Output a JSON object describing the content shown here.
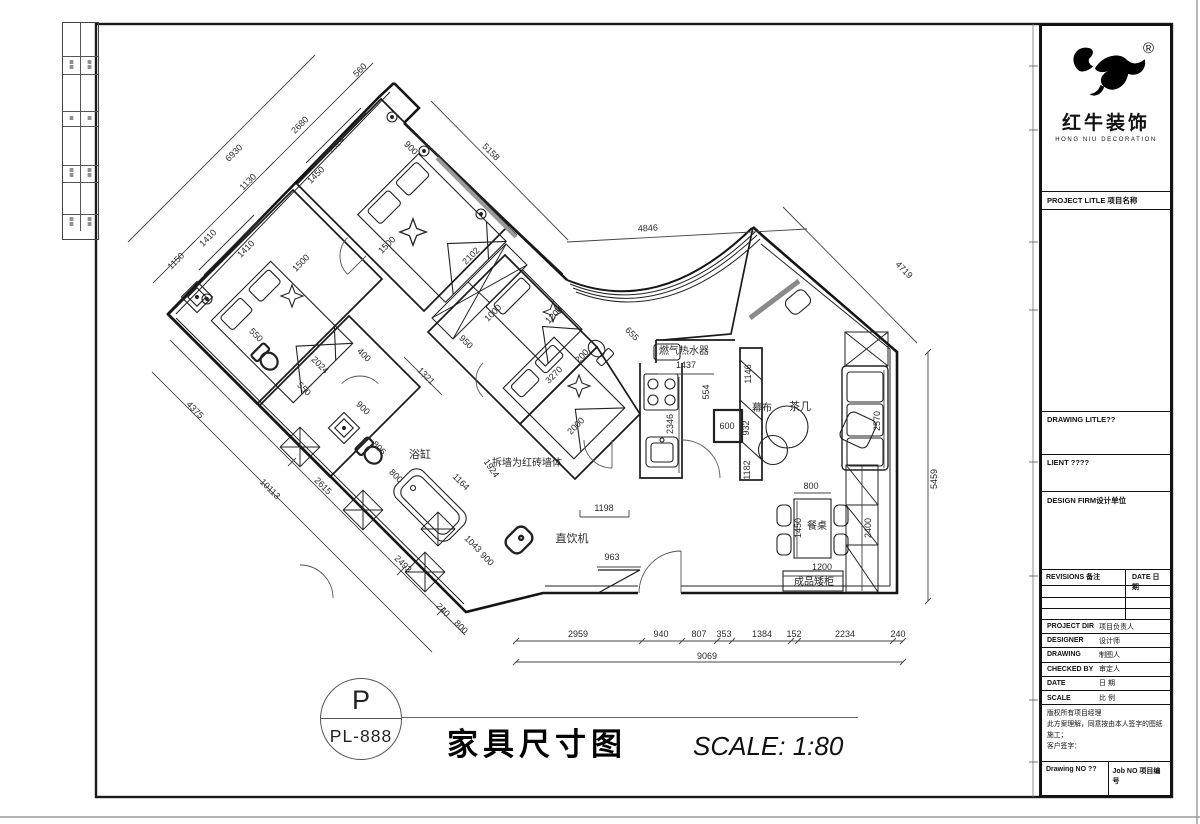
{
  "strip": {
    "glyph": "≣"
  },
  "title_bar": {
    "circle_top": "P",
    "circle_code": "PL-888",
    "title": "家具尺寸图",
    "scale": "SCALE:  1:80"
  },
  "title_block": {
    "logo": {
      "registered": "®",
      "brand": "红牛装饰",
      "brand_en": "HONG NIU DECORATION"
    },
    "project_title": "PROJECT LITLE  项目名称",
    "drawing_title": "DRAWING  LITLE??",
    "client": "LIENT ????",
    "design_firm": "DESIGN  FIRM设计单位",
    "revisions": {
      "col1": "REVISIONS 备注",
      "col2": "DATE 日期"
    },
    "info_rows": [
      {
        "en": "PROJECT DIR",
        "cn": "项目负责人"
      },
      {
        "en": "DESIGNER",
        "cn": "设计师"
      },
      {
        "en": "DRAWING",
        "cn": "制图人"
      },
      {
        "en": "CHECKED BY",
        "cn": "审定人"
      },
      {
        "en": "DATE",
        "cn": "日  期"
      },
      {
        "en": "SCALE",
        "cn": "比  例"
      }
    ],
    "notice": [
      "版权所有项目经理",
      "此方案理解，同意按由本人签字的图纸施工；",
      "客户签字："
    ],
    "footer": {
      "left": "Drawing NO ??",
      "right": "Job NO  项目编号"
    }
  },
  "plan": {
    "labels": [
      {
        "t": "560",
        "x": 362,
        "y": 72,
        "r": -45
      },
      {
        "t": "2680",
        "x": 302,
        "y": 127,
        "r": -45
      },
      {
        "t": "6930",
        "x": 236,
        "y": 155,
        "r": -45
      },
      {
        "t": "1130",
        "x": 250,
        "y": 184,
        "r": -45
      },
      {
        "t": "1410",
        "x": 210,
        "y": 240,
        "r": -45
      },
      {
        "t": "1150",
        "x": 178,
        "y": 263,
        "r": -45
      },
      {
        "t": "1324",
        "x": 338,
        "y": 147,
        "r": -45
      },
      {
        "t": "1450",
        "x": 318,
        "y": 177,
        "r": -45
      },
      {
        "t": "900",
        "x": 409,
        "y": 150,
        "r": 45
      },
      {
        "t": "1500",
        "x": 389,
        "y": 247,
        "r": -45
      },
      {
        "t": "1410",
        "x": 248,
        "y": 251,
        "r": -45
      },
      {
        "t": "1500",
        "x": 303,
        "y": 265,
        "r": -45
      },
      {
        "t": "550",
        "x": 254,
        "y": 337,
        "r": 45
      },
      {
        "t": "5158",
        "x": 489,
        "y": 154,
        "r": 45
      },
      {
        "t": "4846",
        "x": 648,
        "y": 231,
        "r": -3
      },
      {
        "t": "4719",
        "x": 902,
        "y": 272,
        "r": 45
      },
      {
        "t": "655",
        "x": 630,
        "y": 336,
        "r": 45
      },
      {
        "t": "2102",
        "x": 473,
        "y": 258,
        "r": -45
      },
      {
        "t": "1000",
        "x": 495,
        "y": 315,
        "r": -45
      },
      {
        "t": "1200",
        "x": 556,
        "y": 317,
        "r": -45
      },
      {
        "t": "950",
        "x": 464,
        "y": 344,
        "r": 45
      },
      {
        "t": "200",
        "x": 584,
        "y": 358,
        "r": -45
      },
      {
        "t": "3270",
        "x": 556,
        "y": 377,
        "r": -45
      },
      {
        "t": "2000",
        "x": 578,
        "y": 428,
        "r": -45
      },
      {
        "t": "1321",
        "x": 424,
        "y": 378,
        "r": 45
      },
      {
        "t": "2024",
        "x": 318,
        "y": 367,
        "r": 45
      },
      {
        "t": "400",
        "x": 362,
        "y": 357,
        "r": 45
      },
      {
        "t": "550",
        "x": 302,
        "y": 391,
        "r": 45
      },
      {
        "t": "900",
        "x": 361,
        "y": 410,
        "r": 45
      },
      {
        "t": "806",
        "x": 377,
        "y": 450,
        "r": 45
      },
      {
        "t": "800",
        "x": 394,
        "y": 478,
        "r": 45
      },
      {
        "t": "浴缸",
        "x": 420,
        "y": 458,
        "r": 0,
        "s": 11,
        "n": "room-label-bathtub"
      },
      {
        "t": "1164",
        "x": 459,
        "y": 484,
        "r": 45
      },
      {
        "t": "1924",
        "x": 489,
        "y": 470,
        "r": 55
      },
      {
        "t": "拆墙为红砖墙体",
        "x": 527,
        "y": 466,
        "r": 0,
        "s": 10,
        "n": "note-brick-wall"
      },
      {
        "t": "1043",
        "x": 471,
        "y": 546,
        "r": 45
      },
      {
        "t": "900",
        "x": 485,
        "y": 561,
        "r": 45
      },
      {
        "t": "直饮机",
        "x": 572,
        "y": 542,
        "r": 0,
        "s": 11,
        "n": "label-water-dispenser"
      },
      {
        "t": "4375",
        "x": 193,
        "y": 412,
        "r": 45
      },
      {
        "t": "10113",
        "x": 268,
        "y": 491,
        "r": 45
      },
      {
        "t": "2615",
        "x": 321,
        "y": 488,
        "r": 45
      },
      {
        "t": "2493",
        "x": 401,
        "y": 566,
        "r": 45
      },
      {
        "t": "240",
        "x": 441,
        "y": 612,
        "r": 45
      },
      {
        "t": "800",
        "x": 459,
        "y": 629,
        "r": 45
      },
      {
        "t": "963",
        "x": 612,
        "y": 560,
        "r": 0
      },
      {
        "t": "1198",
        "x": 604,
        "y": 511,
        "r": 0
      },
      {
        "t": "燃气热水器",
        "x": 684,
        "y": 354,
        "r": 0,
        "s": 10,
        "n": "label-gas-heater"
      },
      {
        "t": "1437",
        "x": 686,
        "y": 368,
        "r": 0
      },
      {
        "t": "2346",
        "x": 673,
        "y": 424,
        "r": -90
      },
      {
        "t": "554",
        "x": 709,
        "y": 392,
        "r": -90
      },
      {
        "t": "600",
        "x": 727,
        "y": 429,
        "r": 0
      },
      {
        "t": "1146",
        "x": 751,
        "y": 374,
        "r": -90
      },
      {
        "t": "932",
        "x": 749,
        "y": 428,
        "r": -90
      },
      {
        "t": "幕布",
        "x": 762,
        "y": 411,
        "r": 0,
        "s": 10,
        "n": "label-screen"
      },
      {
        "t": "1182",
        "x": 750,
        "y": 470,
        "r": -90
      },
      {
        "t": "茶几",
        "x": 800,
        "y": 410,
        "r": 0,
        "s": 11,
        "n": "label-tea-table"
      },
      {
        "t": "2570",
        "x": 880,
        "y": 421,
        "r": -90
      },
      {
        "t": "800",
        "x": 811,
        "y": 489,
        "r": 0
      },
      {
        "t": "1450",
        "x": 801,
        "y": 528,
        "r": -90
      },
      {
        "t": "餐桌",
        "x": 817,
        "y": 529,
        "r": 0,
        "s": 10,
        "n": "label-dining-table"
      },
      {
        "t": "2400",
        "x": 871,
        "y": 528,
        "r": -90
      },
      {
        "t": "1200",
        "x": 822,
        "y": 570,
        "r": 0
      },
      {
        "t": "成品矮柜",
        "x": 814,
        "y": 585,
        "r": 0,
        "s": 10,
        "n": "label-low-cabinet"
      },
      {
        "t": "5459",
        "x": 937,
        "y": 479,
        "r": -90
      },
      {
        "t": "2959",
        "x": 578,
        "y": 637,
        "r": 0
      },
      {
        "t": "940",
        "x": 661,
        "y": 637,
        "r": 0
      },
      {
        "t": "807",
        "x": 699,
        "y": 637,
        "r": 0
      },
      {
        "t": "353",
        "x": 724,
        "y": 637,
        "r": 0
      },
      {
        "t": "1384",
        "x": 762,
        "y": 637,
        "r": 0
      },
      {
        "t": "152",
        "x": 794,
        "y": 637,
        "r": 0
      },
      {
        "t": "2234",
        "x": 845,
        "y": 637,
        "r": 0
      },
      {
        "t": "240",
        "x": 898,
        "y": 637,
        "r": 0
      },
      {
        "t": "9069",
        "x": 707,
        "y": 659,
        "r": 0
      }
    ]
  }
}
